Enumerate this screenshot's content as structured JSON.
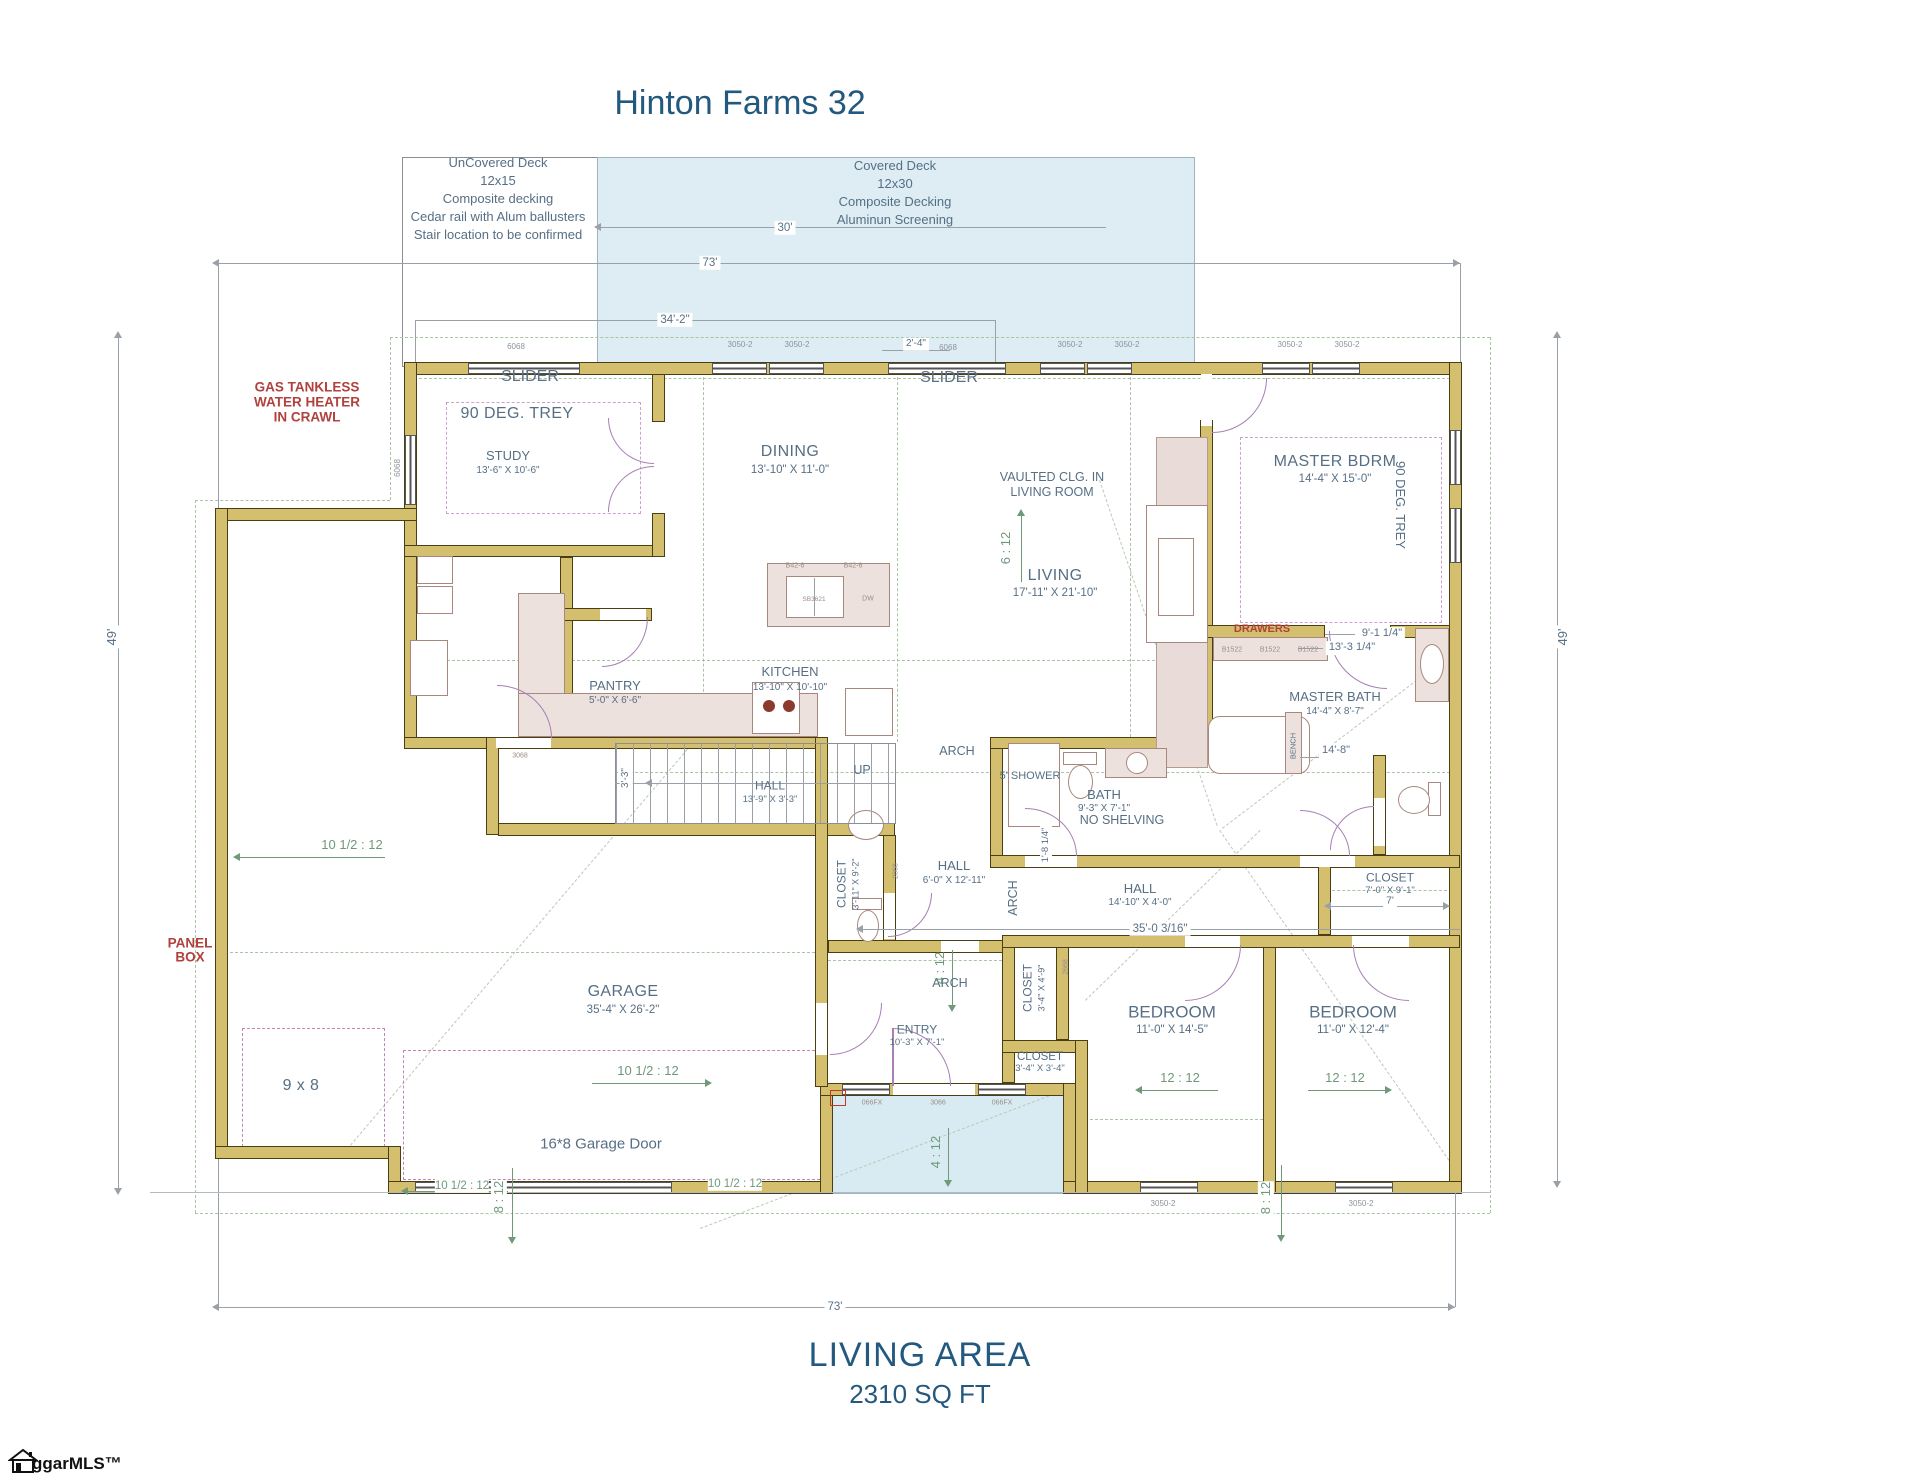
{
  "title": "Hinton Farms 32",
  "deck_uncovered": {
    "l1": "UnCovered Deck",
    "l2": "12x15",
    "l3": "Composite decking",
    "l4": "Cedar rail with Alum ballusters",
    "l5": "Stair location to be confirmed"
  },
  "deck_covered": {
    "l1": "Covered Deck",
    "l2": "12x30",
    "l3": "Composite Decking",
    "l4": "Aluminun Screening"
  },
  "notes": {
    "wh1": "GAS TANKLESS",
    "wh2": "WATER HEATER",
    "wh3": "IN CRAWL",
    "panel1": "PANEL",
    "panel2": "BOX",
    "drawers": "DRAWERS",
    "vaulted1": "VAULTED CLG. IN",
    "vaulted2": "LIVING ROOM",
    "no_shelving": "NO SHELVING",
    "shower": "5' SHOWER",
    "garage_door": "16*8 Garage Door",
    "nine_eight": "9 x 8",
    "trey_study": "90 DEG. TREY",
    "trey_master": "90 DEG. TREY",
    "slider1": "SLIDER",
    "slider2": "SLIDER",
    "arch1": "ARCH",
    "arch2": "ARCH",
    "arch3": "ARCH",
    "up": "UP",
    "bench": "BENCH"
  },
  "rooms": {
    "study": {
      "name": "STUDY",
      "dims": "13'-6\" X 10'-6\""
    },
    "dining": {
      "name": "DINING",
      "dims": "13'-10\" X 11'-0\""
    },
    "living": {
      "name": "LIVING",
      "dims": "17'-11\" X 21'-10\""
    },
    "master": {
      "name": "MASTER BDRM",
      "dims": "14'-4\" X 15'-0\""
    },
    "kitchen": {
      "name": "KITCHEN",
      "dims": "13'-10\" X 10'-10\""
    },
    "pantry": {
      "name": "PANTRY",
      "dims": "5'-0\" X 6'-6\""
    },
    "hall_stairs": {
      "name": "HALL",
      "dims": "13'-9\" X 3'-3\""
    },
    "master_bath": {
      "name": "MASTER BATH",
      "dims": "14'-4\" X 8'-7\""
    },
    "bath": {
      "name": "BATH",
      "dims": "9'-3\" X 7'-1\""
    },
    "closet_powder": {
      "name": "CLOSET",
      "dims": "3'-11\" X 9'-2\""
    },
    "hall_mid": {
      "name": "HALL",
      "dims": "6'-0\" X 12'-11\""
    },
    "hall_bed": {
      "name": "HALL",
      "dims": "14'-10\" X 4'-0\""
    },
    "closet_master2": {
      "name": "CLOSET",
      "dims": "7'-0\" X 9'-1\""
    },
    "closet_bed1": {
      "name": "CLOSET",
      "dims": "3'-4\" X 4'-9\""
    },
    "closet_entry": {
      "name": "CLOSET",
      "dims": "3'-4\" X 3'-4\""
    },
    "bedroom1": {
      "name": "BEDROOM",
      "dims": "11'-0\" X 14'-5\""
    },
    "bedroom2": {
      "name": "BEDROOM",
      "dims": "11'-0\" X 12'-4\""
    },
    "entry": {
      "name": "ENTRY",
      "dims": "10'-3\" X 7'-1\""
    },
    "garage": {
      "name": "GARAGE",
      "dims": "35'-4\" X 26'-2\""
    }
  },
  "dims": {
    "top73": "73'",
    "bottom73": "73'",
    "left49": "49'",
    "right49": "49'",
    "w342": "34'-2\"",
    "w24": "2'-4\"",
    "w30": "30'",
    "stair33": "3'-3\"",
    "hall35": "35'-0 3/16\"",
    "cl7": "7'",
    "m91": "9'-1 1/4\"",
    "m133": "13'-3 1/4\"",
    "m148": "14'-8\"",
    "b18": "1'-8 1/4\""
  },
  "pitches": {
    "living": "6 : 12",
    "garageL": "10 1/2 : 12",
    "garageR": "10 1/2 : 12",
    "frontL": "10 1/2 : 12",
    "frontR": "10 1/2 : 12",
    "bed1": "12 : 12",
    "bed2": "12 : 12",
    "doorG": "8 : 12",
    "bedMid": "8 : 12",
    "porch": "4 : 12",
    "entry": "4 : 12"
  },
  "codes": {
    "c1": "6068",
    "c2": "3050-2",
    "c3": "3050-2",
    "c4": "6068",
    "c5": "3050-2",
    "c6": "3050-2",
    "c7": "3050-2",
    "c8": "3050-2",
    "c9": "3050-2",
    "c10": "3050-2",
    "c11": "066FX",
    "c12": "3066",
    "c13": "066FX",
    "c14": "3068",
    "c15": "2868",
    "c16": "2668",
    "c17": "6068",
    "k1": "B42-6",
    "k2": "B42-6",
    "k3": "SB3621",
    "k4": "DW",
    "d1": "B1522",
    "d2": "B1522",
    "d3": "B1522"
  },
  "footer": {
    "line1": "LIVING AREA",
    "line2": "2310 SQ FT"
  },
  "logo": "ggarMLS™"
}
